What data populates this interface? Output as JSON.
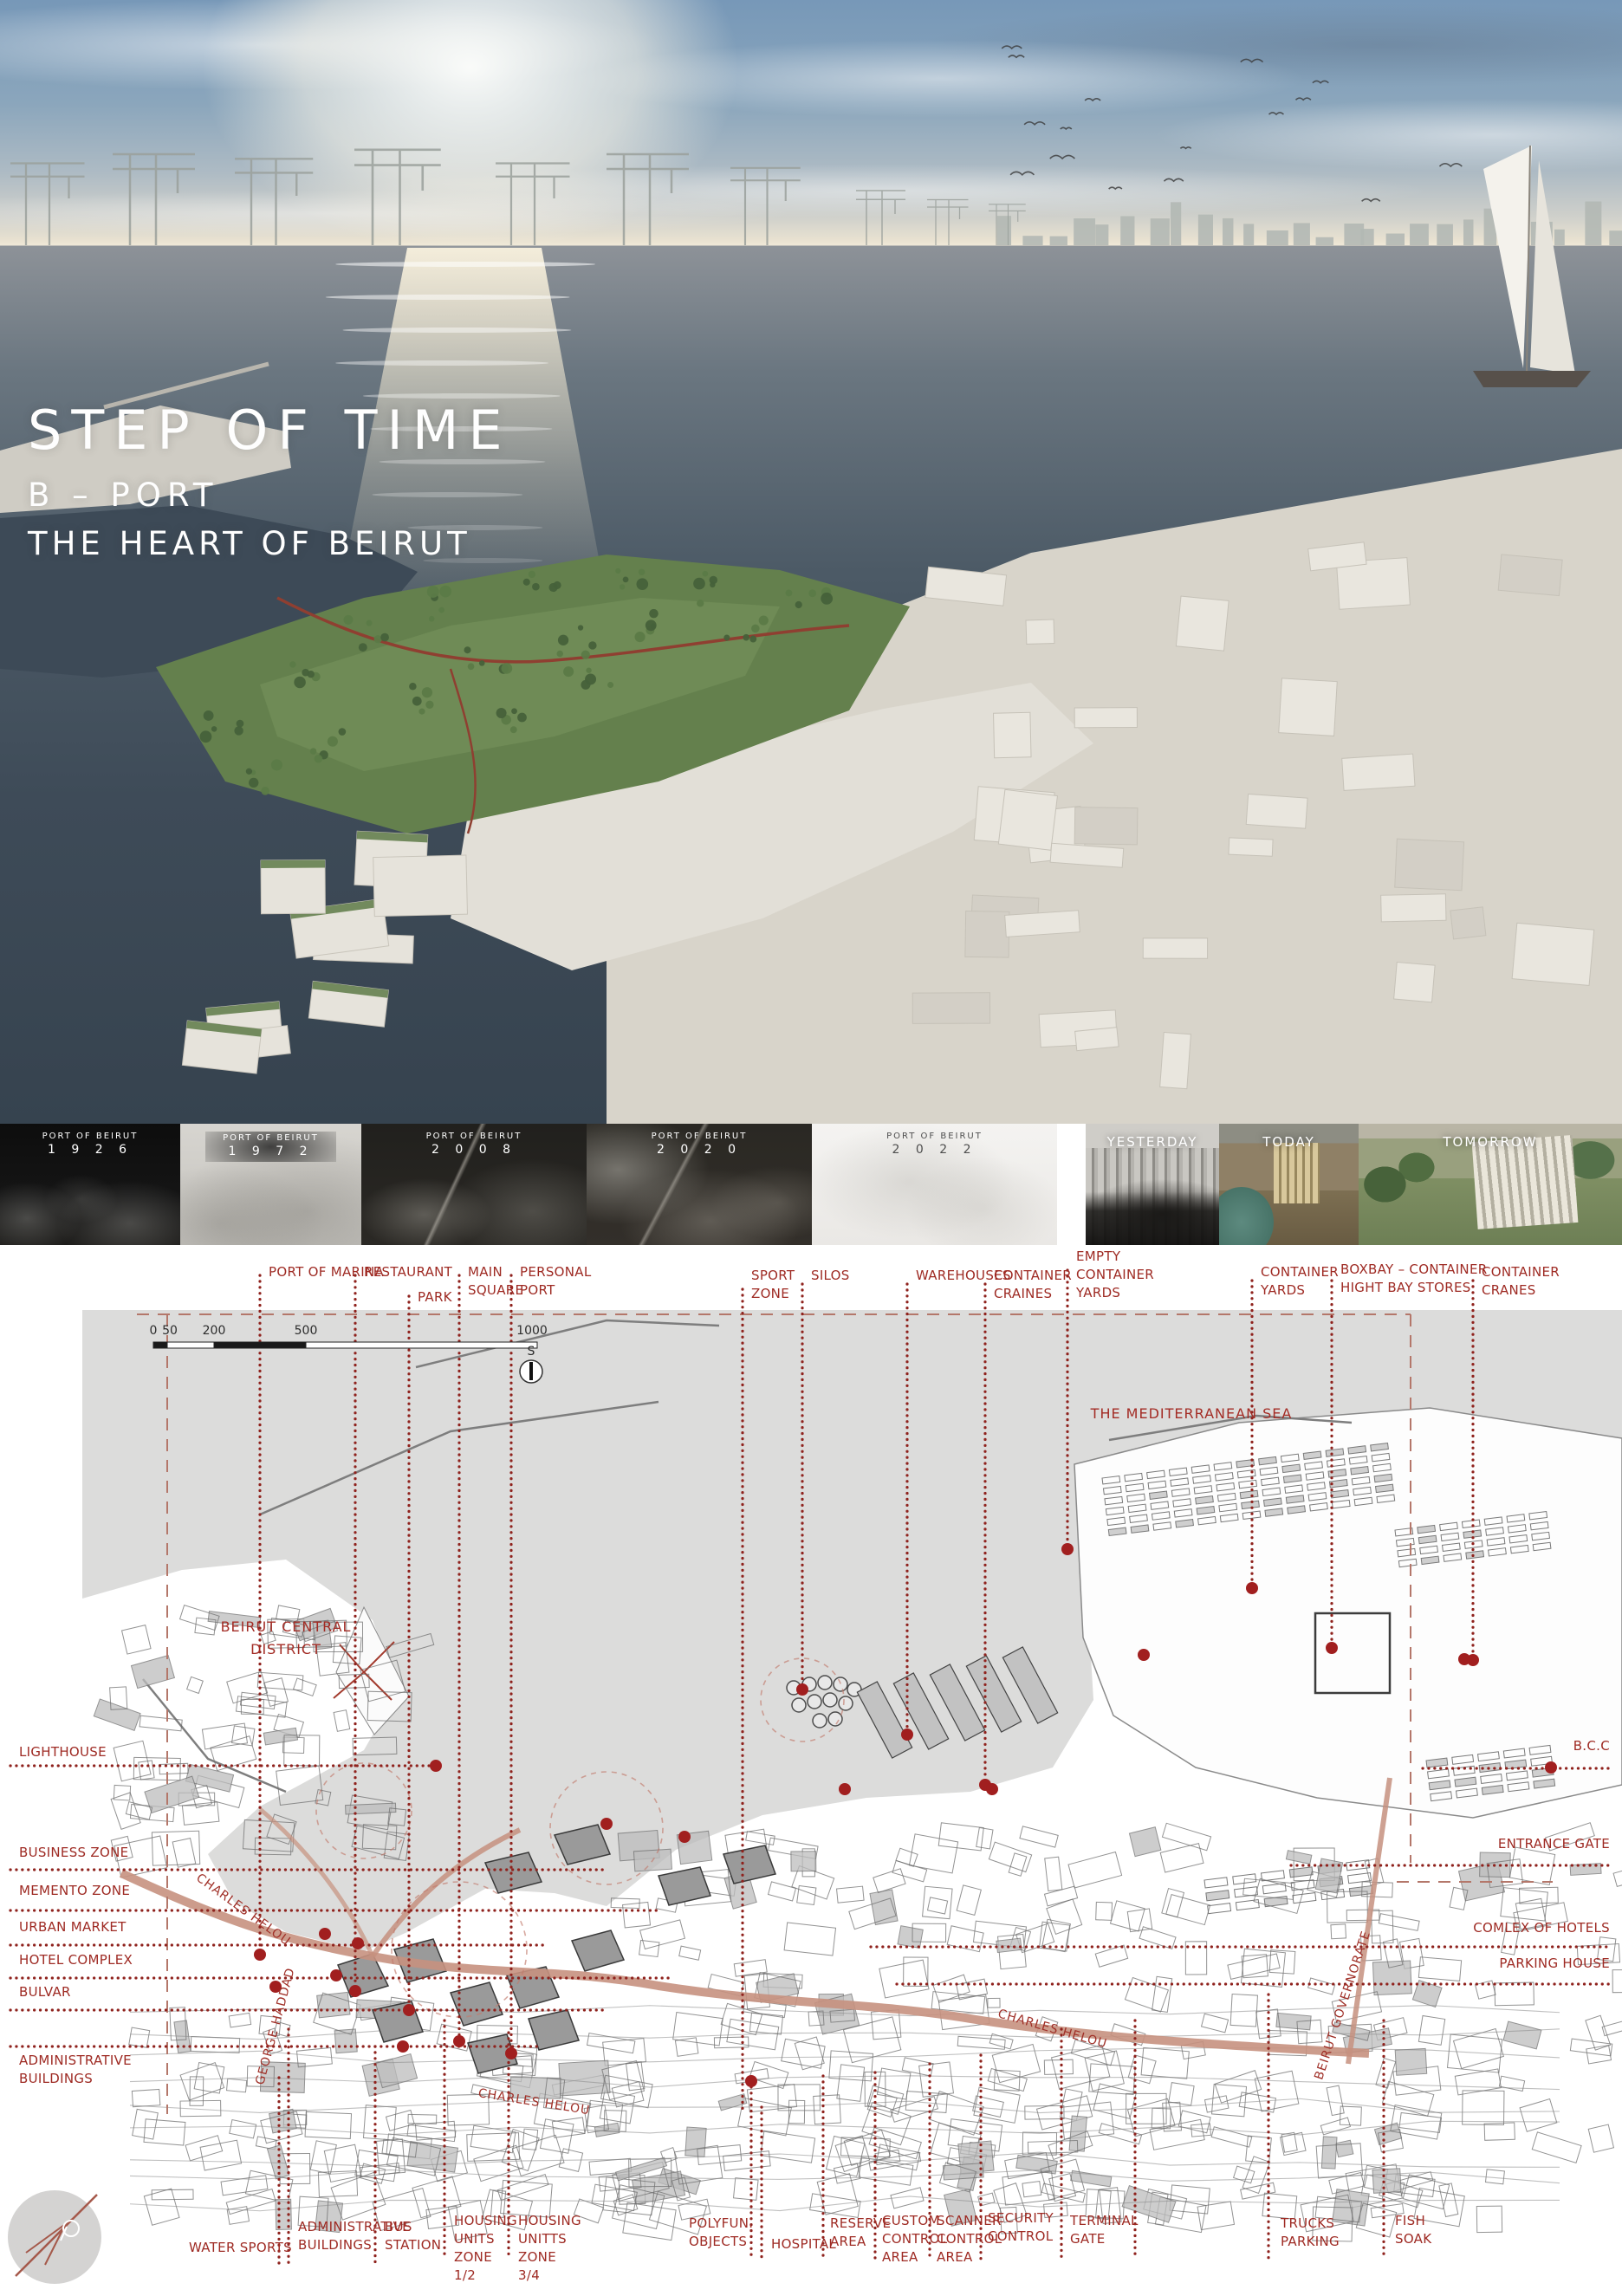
{
  "poster": {
    "title": "STEP OF TIME",
    "subtitle": "B – PORT",
    "tagline": "THE HEART OF BEIRUT"
  },
  "timeline": {
    "panels": [
      {
        "heading": "PORT OF BEIRUT",
        "year": "1 9 2 6"
      },
      {
        "heading": "PORT OF BEIRUT",
        "year": "1 9 7 2"
      },
      {
        "heading": "PORT OF BEIRUT",
        "year": "2 0 0 8"
      },
      {
        "heading": "PORT OF BEIRUT",
        "year": "2 0 2 0"
      },
      {
        "heading": "PORT OF BEIRUT",
        "year": "2 0 2 2"
      }
    ],
    "photos": [
      {
        "label": "YESTERDAY"
      },
      {
        "label": "TODAY"
      },
      {
        "label": "TOMORROW"
      }
    ]
  },
  "map": {
    "sea_label": "THE MEDITERRANEAN SEA",
    "district_label_line1": "BEIRUT CENTRAL",
    "district_label_line2": "DISTRICT",
    "street_labels": {
      "charles_helou_west": "CHARLES HELOU",
      "george_haddad": "GEORGE HADDAD",
      "charles_helou_mid": "CHARLES HELOU",
      "charles_helou_east": "CHARLES HELOU",
      "beirut_governorate": "BEIRUT GOVERNORATE"
    },
    "compass_letter": "S",
    "scalebar_ticks": [
      "0",
      "50",
      "200",
      "500",
      "1000"
    ],
    "top_labels": [
      {
        "text": "PORT OF MARINA"
      },
      {
        "text": "RESTAURANT"
      },
      {
        "text": "PARK"
      },
      {
        "text": "MAIN SQUARE"
      },
      {
        "text": "PERSONAL PORT"
      },
      {
        "text": "SPORT ZONE"
      },
      {
        "text": "SILOS"
      },
      {
        "text": "WAREHOUSES"
      },
      {
        "text": "CONTAINER CRAINES"
      },
      {
        "text": "EMPTY CONTAINER YARDS"
      },
      {
        "text": "CONTAINER YARDS"
      },
      {
        "text": "BOXBAY – CONTAINER HIGHT BAY STORES"
      },
      {
        "text": "CONTAINER CRANES"
      }
    ],
    "left_labels": [
      {
        "text": "LIGHTHOUSE"
      },
      {
        "text": "BUSINESS ZONE"
      },
      {
        "text": "MEMENTO ZONE"
      },
      {
        "text": "URBAN MARKET"
      },
      {
        "text": "HOTEL COMPLEX"
      },
      {
        "text": "BULVAR"
      },
      {
        "text": "ADMINISTRATIVE BUILDINGS"
      }
    ],
    "right_labels": [
      {
        "text": "B.C.C"
      },
      {
        "text": "ENTRANCE GATE"
      },
      {
        "text": "COMLEX OF HOTELS"
      },
      {
        "text": "PARKING HOUSE"
      }
    ],
    "bottom_labels": [
      {
        "text": "WATER SPORTS"
      },
      {
        "text": "ADMINISTRATIVE BUILDINGS"
      },
      {
        "text": "BUS STATION"
      },
      {
        "text": "HOUSING UNITS ZONE 1/2"
      },
      {
        "text": "HOUSING UNITTS ZONE 3/4"
      },
      {
        "text": "POLYFUN. OBJECTS"
      },
      {
        "text": "HOSPITAL"
      },
      {
        "text": "RESERVE AREA"
      },
      {
        "text": "CUSTOM CONTROL AREA"
      },
      {
        "text": "SCANNER CONTROL AREA"
      },
      {
        "text": "SECURITY CONTROL"
      },
      {
        "text": "TERMINAL GATE"
      },
      {
        "text": "TRUCKS PARKING"
      },
      {
        "text": "FISH SOAK"
      }
    ]
  },
  "colors": {
    "label_red": "#9e2a23",
    "leader_red": "#8f221d",
    "road_salmon": "#c6917f",
    "sea_gray": "#dcdcdb",
    "accent_dot": "#a11f1f"
  }
}
